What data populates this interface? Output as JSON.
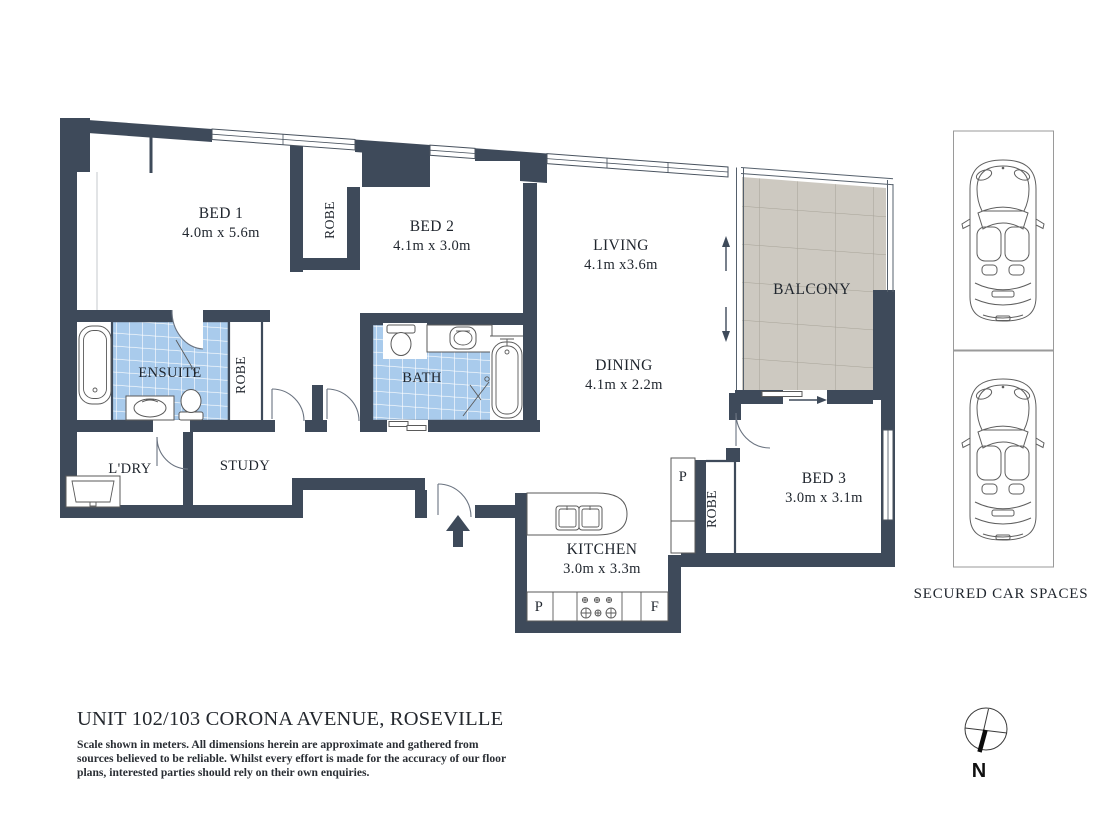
{
  "rooms": {
    "bed1": {
      "label": "BED 1",
      "dims": "4.0m x 5.6m"
    },
    "bed2": {
      "label": "BED 2",
      "dims": "4.1m x 3.0m"
    },
    "bed3": {
      "label": "BED 3",
      "dims": "3.0m x 3.1m"
    },
    "living": {
      "label": "LIVING",
      "dims": "4.1m x3.6m"
    },
    "dining": {
      "label": "DINING",
      "dims": "4.1m x 2.2m"
    },
    "kitchen": {
      "label": "KITCHEN",
      "dims": "3.0m x 3.3m"
    },
    "balcony": {
      "label": "BALCONY"
    },
    "ensuite": {
      "label": "ENSUITE"
    },
    "bath": {
      "label": "BATH"
    },
    "study": {
      "label": "STUDY"
    },
    "laundry": {
      "label": "L'DRY"
    },
    "robe_bed1": {
      "label": "ROBE"
    },
    "robe_ensuite": {
      "label": "ROBE"
    },
    "robe_bed3": {
      "label": "ROBE"
    }
  },
  "markers": {
    "pantry_bed3": "P",
    "pantry_kitchen": "P",
    "fridge": "F"
  },
  "compass": {
    "north": "N"
  },
  "car_area": {
    "caption": "SECURED CAR SPACES",
    "spaces": 2
  },
  "footer": {
    "title": "UNIT 102/103 CORONA AVENUE, ROSEVILLE",
    "disclaimer_lines": [
      "Scale shown in meters. All dimensions herein are approximate and gathered from",
      "sources believed to be reliable. Whilst every effort is made for the accuracy of our floor",
      "plans, interested parties should rely on their own enquiries."
    ]
  },
  "colors": {
    "wall": "#3E4A5A",
    "tile_fill": "#A9CBEC",
    "tile_grout": "#FFFFFF",
    "balcony_tile_fill": "#CDC9C1",
    "balcony_tile_grout": "#A6A298",
    "fixture_line": "#555555",
    "text": "#20262E"
  }
}
